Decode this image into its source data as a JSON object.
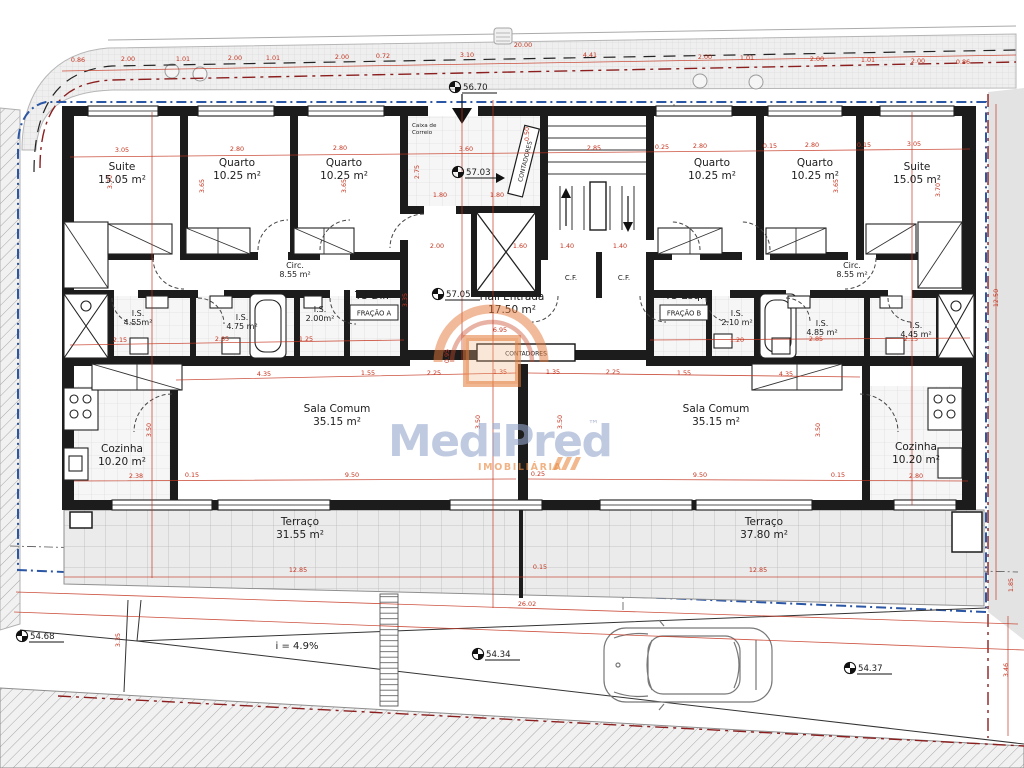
{
  "watermark": {
    "brand": "MediPred",
    "tm": "™",
    "tagline": "IMOBILIÁRIA"
  },
  "units": {
    "left": {
      "type_label": "T3 Dir.",
      "fraction_label": "FRAÇÃO A"
    },
    "right": {
      "type_label": "T3 Esq.",
      "fraction_label": "FRAÇÃO B"
    }
  },
  "labels": {
    "mailbox_line1": "Caixa de",
    "mailbox_line2": "Correio",
    "meters_vertical": "CONTADORES",
    "meters_box": "CONTADORES",
    "closet": "C.F.",
    "ramp_slope": "i = 4.9%"
  },
  "colors": {
    "dim_red": "#c3341f",
    "boundary_blue": "#2b56a4",
    "boundary_dark_red": "#8b1f1f",
    "wall": "#1c1c1c",
    "watermark_blue": "rgba(148,166,205,0.60)",
    "watermark_orange": "rgba(233,138,66,0.65)"
  },
  "rooms": [
    {
      "n": "Suite",
      "a": "15.05 m²",
      "x": 122,
      "y": 170
    },
    {
      "n": "Quarto",
      "a": "10.25 m²",
      "x": 237,
      "y": 166
    },
    {
      "n": "Quarto",
      "a": "10.25 m²",
      "x": 344,
      "y": 166
    },
    {
      "n": "Quarto",
      "a": "10.25 m²",
      "x": 712,
      "y": 166
    },
    {
      "n": "Quarto",
      "a": "10.25 m²",
      "x": 815,
      "y": 166
    },
    {
      "n": "Suite",
      "a": "15.05 m²",
      "x": 917,
      "y": 170
    },
    {
      "n": "Circ.",
      "a": "8.55 m²",
      "x": 295,
      "y": 268,
      "s": 1
    },
    {
      "n": "Circ.",
      "a": "8.55 m²",
      "x": 852,
      "y": 268,
      "s": 1
    },
    {
      "n": "Hall Entrada",
      "a": "17.50 m²",
      "x": 512,
      "y": 300
    },
    {
      "n": "I.S.",
      "a": "4.55m²",
      "x": 138,
      "y": 316,
      "s": 1
    },
    {
      "n": "I.S.",
      "a": "4.75 m²",
      "x": 242,
      "y": 320,
      "s": 1
    },
    {
      "n": "I.S.",
      "a": "2.00m²",
      "x": 320,
      "y": 312,
      "s": 1
    },
    {
      "n": "I.S.",
      "a": "2.10 m²",
      "x": 737,
      "y": 316,
      "s": 1
    },
    {
      "n": "I.S.",
      "a": "4.85 m²",
      "x": 822,
      "y": 326,
      "s": 1
    },
    {
      "n": "I.S.",
      "a": "4.45 m²",
      "x": 916,
      "y": 328,
      "s": 1
    },
    {
      "n": "Cozinha",
      "a": "10.20 m²",
      "x": 122,
      "y": 452
    },
    {
      "n": "Sala Comum",
      "a": "35.15 m²",
      "x": 337,
      "y": 412
    },
    {
      "n": "Sala Comum",
      "a": "35.15 m²",
      "x": 716,
      "y": 412
    },
    {
      "n": "Cozinha",
      "a": "10.20 m²",
      "x": 916,
      "y": 450
    },
    {
      "n": "Terraço",
      "a": "31.55 m²",
      "x": 300,
      "y": 525
    },
    {
      "n": "Terraço",
      "a": "37.80 m²",
      "x": 764,
      "y": 525
    }
  ],
  "dims": [
    {
      "v": "0.86",
      "x": 78,
      "y": 62
    },
    {
      "v": "2.00",
      "x": 128,
      "y": 61
    },
    {
      "v": "1.01",
      "x": 183,
      "y": 61
    },
    {
      "v": "2.00",
      "x": 235,
      "y": 60
    },
    {
      "v": "1.01",
      "x": 273,
      "y": 60
    },
    {
      "v": "2.00",
      "x": 342,
      "y": 59
    },
    {
      "v": "0.72",
      "x": 383,
      "y": 58
    },
    {
      "v": "3.10",
      "x": 467,
      "y": 57
    },
    {
      "v": "20.00",
      "x": 523,
      "y": 47
    },
    {
      "v": "4.41",
      "x": 590,
      "y": 57
    },
    {
      "v": "2.00",
      "x": 705,
      "y": 59
    },
    {
      "v": "1.01",
      "x": 747,
      "y": 60
    },
    {
      "v": "2.00",
      "x": 817,
      "y": 61
    },
    {
      "v": "1.01",
      "x": 868,
      "y": 62
    },
    {
      "v": "2.00",
      "x": 918,
      "y": 63
    },
    {
      "v": "0.86",
      "x": 963,
      "y": 64
    },
    {
      "v": "3.05",
      "x": 122,
      "y": 152
    },
    {
      "v": "2.80",
      "x": 237,
      "y": 151
    },
    {
      "v": "2.80",
      "x": 340,
      "y": 150
    },
    {
      "v": "3.60",
      "x": 466,
      "y": 151
    },
    {
      "v": "2.85",
      "x": 594,
      "y": 150
    },
    {
      "v": "0.25",
      "x": 662,
      "y": 149
    },
    {
      "v": "2.80",
      "x": 700,
      "y": 148
    },
    {
      "v": "0.15",
      "x": 770,
      "y": 148
    },
    {
      "v": "2.80",
      "x": 812,
      "y": 147
    },
    {
      "v": "0.15",
      "x": 864,
      "y": 147
    },
    {
      "v": "3.05",
      "x": 914,
      "y": 146
    },
    {
      "v": "3.70",
      "x": 112,
      "y": 182,
      "r": -90
    },
    {
      "v": "3.65",
      "x": 204,
      "y": 186,
      "r": -90
    },
    {
      "v": "3.65",
      "x": 346,
      "y": 186,
      "r": -90
    },
    {
      "v": "2.75",
      "x": 419,
      "y": 172,
      "r": -90
    },
    {
      "v": "0.50",
      "x": 529,
      "y": 134,
      "r": -90
    },
    {
      "v": "3.65",
      "x": 838,
      "y": 186,
      "r": -90
    },
    {
      "v": "3.70",
      "x": 940,
      "y": 190,
      "r": -90
    },
    {
      "v": "1.80",
      "x": 440,
      "y": 197
    },
    {
      "v": "1.80",
      "x": 497,
      "y": 197
    },
    {
      "v": "2.00",
      "x": 437,
      "y": 248
    },
    {
      "v": "1.60",
      "x": 520,
      "y": 248
    },
    {
      "v": "1.40",
      "x": 567,
      "y": 248
    },
    {
      "v": "1.40",
      "x": 620,
      "y": 248
    },
    {
      "v": "3.35",
      "x": 407,
      "y": 300,
      "r": -90
    },
    {
      "v": "6.95",
      "x": 500,
      "y": 332
    },
    {
      "v": "2.15",
      "x": 120,
      "y": 342
    },
    {
      "v": "2.85",
      "x": 222,
      "y": 341
    },
    {
      "v": "1.25",
      "x": 306,
      "y": 341
    },
    {
      "v": "1.20",
      "x": 737,
      "y": 342
    },
    {
      "v": "2.85",
      "x": 816,
      "y": 341
    },
    {
      "v": "2.15",
      "x": 911,
      "y": 341
    },
    {
      "v": "4.35",
      "x": 264,
      "y": 376
    },
    {
      "v": "1.55",
      "x": 368,
      "y": 375
    },
    {
      "v": "2.25",
      "x": 434,
      "y": 375
    },
    {
      "v": "1.35",
      "x": 500,
      "y": 374
    },
    {
      "v": "1.35",
      "x": 553,
      "y": 374
    },
    {
      "v": "2.25",
      "x": 613,
      "y": 374
    },
    {
      "v": "1.55",
      "x": 684,
      "y": 375
    },
    {
      "v": "4.35",
      "x": 786,
      "y": 376
    },
    {
      "v": "3.50",
      "x": 151,
      "y": 430,
      "r": -90
    },
    {
      "v": "3.50",
      "x": 480,
      "y": 422,
      "r": -90
    },
    {
      "v": "3.50",
      "x": 562,
      "y": 422,
      "r": -90
    },
    {
      "v": "3.50",
      "x": 820,
      "y": 430,
      "r": -90
    },
    {
      "v": "0.95",
      "x": 449,
      "y": 356,
      "r": -90
    },
    {
      "v": "2.38",
      "x": 136,
      "y": 478
    },
    {
      "v": "0.15",
      "x": 192,
      "y": 477
    },
    {
      "v": "9.50",
      "x": 352,
      "y": 477
    },
    {
      "v": "0.25",
      "x": 538,
      "y": 476
    },
    {
      "v": "9.50",
      "x": 700,
      "y": 477
    },
    {
      "v": "0.15",
      "x": 838,
      "y": 477
    },
    {
      "v": "2.80",
      "x": 916,
      "y": 478
    },
    {
      "v": "12.85",
      "x": 298,
      "y": 572
    },
    {
      "v": "0.15",
      "x": 540,
      "y": 569
    },
    {
      "v": "12.85",
      "x": 758,
      "y": 572
    },
    {
      "v": "26.02",
      "x": 527,
      "y": 606
    },
    {
      "v": "3.35",
      "x": 120,
      "y": 640,
      "r": -90
    },
    {
      "v": "12.50",
      "x": 998,
      "y": 298,
      "r": -90
    },
    {
      "v": "1.85",
      "x": 1013,
      "y": 585,
      "r": -90
    },
    {
      "v": "3.46",
      "x": 1008,
      "y": 670,
      "r": -90
    }
  ],
  "benchmarks": [
    {
      "v": "56.70",
      "x": 455,
      "y": 87
    },
    {
      "v": "57.03",
      "x": 458,
      "y": 172
    },
    {
      "v": "57.05",
      "x": 438,
      "y": 294
    },
    {
      "v": "54.68",
      "x": 22,
      "y": 636
    },
    {
      "v": "54.34",
      "x": 478,
      "y": 654
    },
    {
      "v": "54.37",
      "x": 850,
      "y": 668
    }
  ]
}
